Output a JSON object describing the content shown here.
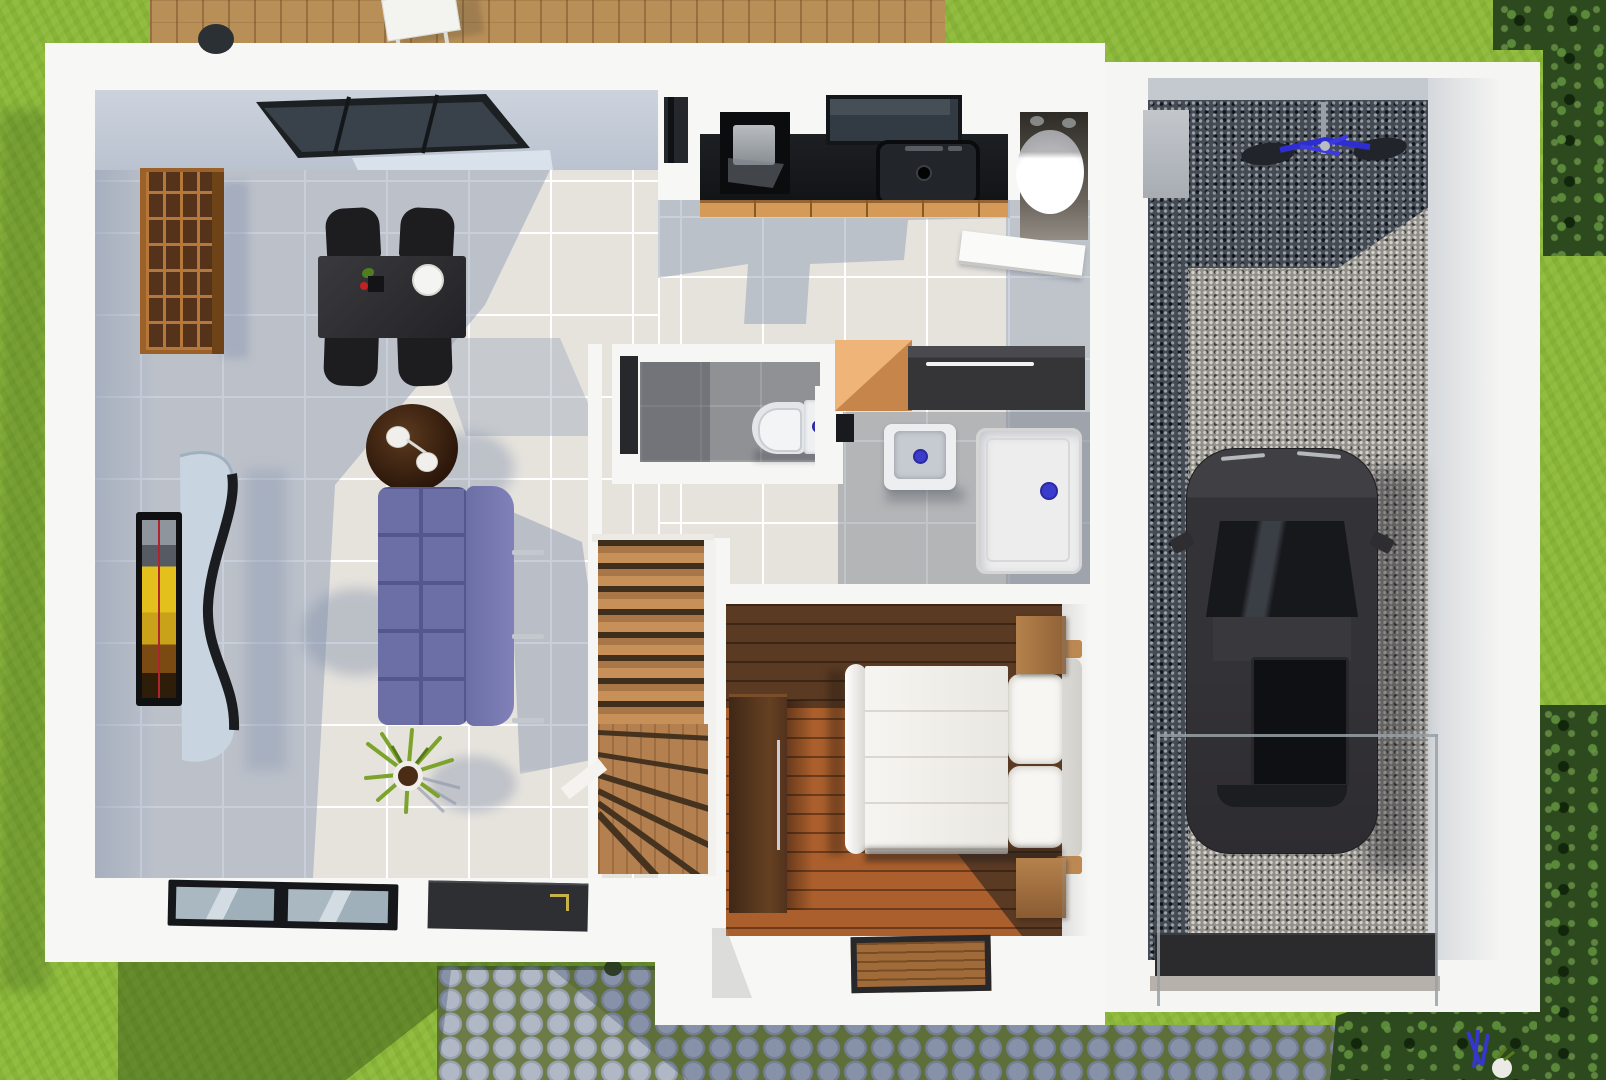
{
  "scene": {
    "title": "Top-down 3D rendered ground-floor plan of a house with attached garage, lawn, wooden deck and cobblestone path",
    "type": "architectural-floor-plan-3d-render",
    "view": "top-down",
    "floor": "ground floor"
  },
  "rooms": [
    {
      "name": "Living and dining room",
      "floor_finish": "light gray tiles with skylight shadow",
      "furniture": [
        "wooden cube bookshelf",
        "black dining table with four chairs",
        "white dinner plate",
        "dark round side table with two cups",
        "wall TV with curved media stand",
        "oval gray coffee table",
        "purple tufted sofa",
        "potted plant",
        "two glass floor panels",
        "dark doormat"
      ]
    },
    {
      "name": "Kitchen",
      "floor_finish": "gray tiles",
      "furniture": [
        "black countertop",
        "cooktop with pot",
        "black sink with faucet",
        "orange base cabinets",
        "window above sink"
      ]
    },
    {
      "name": "Utility closet",
      "furniture": [
        "white cylindrical water heater",
        "open white door"
      ]
    },
    {
      "name": "WC",
      "floor_finish": "gray tiles",
      "furniture": [
        "toilet with cistern and blue flush button"
      ]
    },
    {
      "name": "Bathroom",
      "floor_finish": "gray tiles",
      "furniture": [
        "white washbasin with blue drain",
        "white shower tray with blue drain",
        "orange cabinet",
        "dark sideboard with white handle"
      ]
    },
    {
      "name": "Staircase",
      "furniture": [
        "wooden winder staircase with white stringers"
      ]
    },
    {
      "name": "Bedroom",
      "floor_finish": "wooden planks, sunlit",
      "furniture": [
        "double bed with white duvet and two pillows",
        "two wooden nightstands",
        "dark brown wardrobe",
        "wooden doormat"
      ]
    },
    {
      "name": "Garage",
      "floor_finish": "dark gravel with sunlit strip",
      "furniture": [
        "black car seen from above",
        "blue bicycle on wall mount",
        "gray storage box",
        "glass partition",
        "dark garage door plate"
      ]
    }
  ],
  "exterior": {
    "features": [
      "green lawn",
      "wooden deck with white table and dark stool",
      "cobblestone path with grass joints",
      "hedges and trees along right edge",
      "bushes at bottom right",
      "blue garden tools on path",
      "building shadows on lawn"
    ]
  },
  "colors": {
    "lawn": "#8CB93E",
    "deck_wood": "#B98F58",
    "living_tile": "#E6E3DD",
    "shadow_blue": "#8C9AB4",
    "hall_tile_shadow": "#8A98B2",
    "wc_tile": "#8F9194",
    "stair_wood": "#B5804F",
    "bedroom_wood_dark": "#5B3A23",
    "bedroom_wood_sunlit": "#B2622D",
    "sofa_purple": "#6C6EA6",
    "counter_black": "#17191C",
    "cabinet_orange": "#D69A58",
    "bookshelf_wood": "#B5773A",
    "car_body": "#333236",
    "gravel_dark": "#454B54",
    "gravel_light": "#93908A",
    "cobblestone": "#8792A8",
    "hedge_green": "#2C4A1E",
    "fixture_blue": "#3C3CCC",
    "wall_white": "#F7F7F5",
    "bicycle_blue": "#2D2DD0"
  }
}
